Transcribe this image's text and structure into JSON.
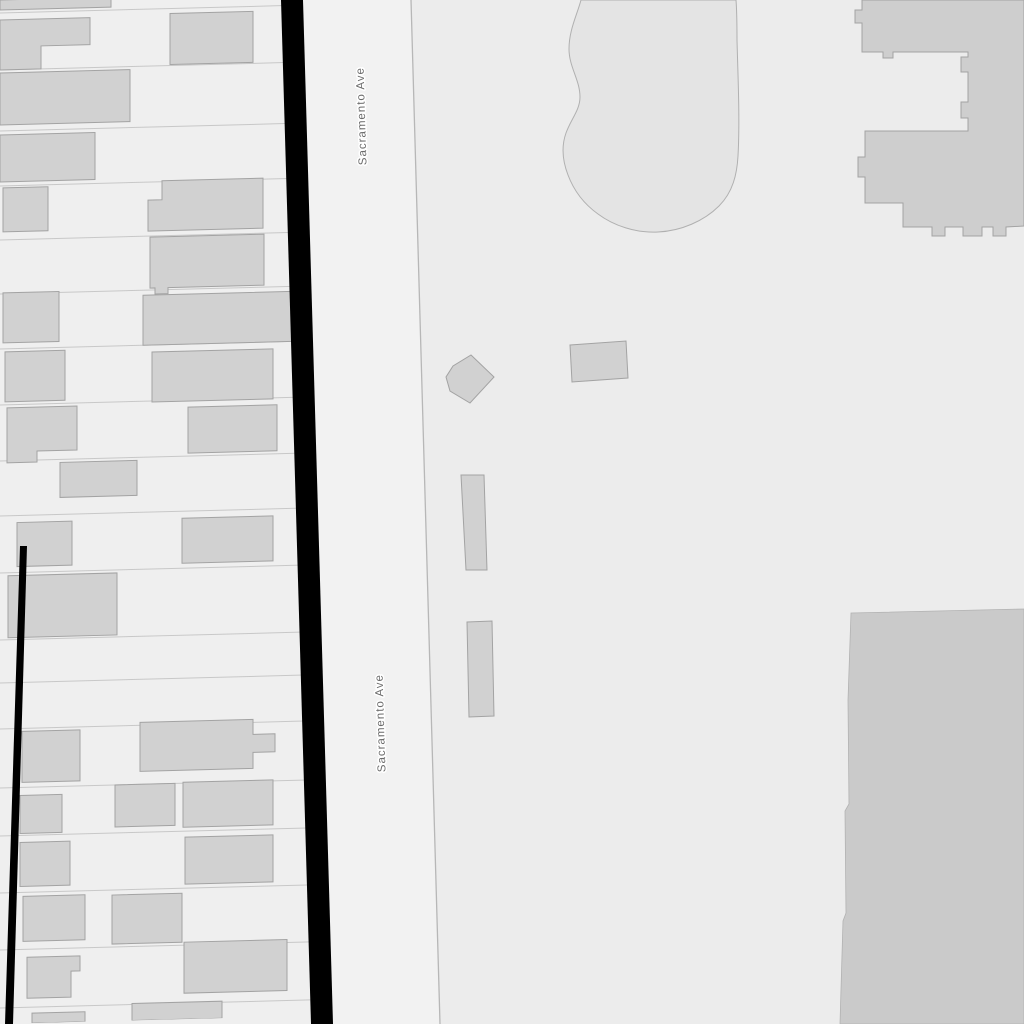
{
  "map": {
    "street": {
      "name": "Sacramento Ave"
    },
    "labels": [
      {
        "text": "Sacramento Ave"
      },
      {
        "text": "Sacramento Ave"
      }
    ],
    "colors": {
      "parcel_background": "#efefef",
      "parcel_line": "#c8c8c8",
      "building_fill": "#d1d1d1",
      "building_stroke": "#a3a3a3",
      "road_fill": "#f2f2f2",
      "road_casing": "#000000",
      "right_block_background": "#ececec",
      "boundary_line": "#b7b7b7",
      "pond_fill": "#e4e4e4",
      "pond_stroke": "#b0b0b0",
      "large_building_fill": "#cecece",
      "dark_block_fill": "#cacaca",
      "dark_block_stroke": "#b2b2b2",
      "label_color": "#6b6b6b",
      "label_halo": "#ffffff"
    }
  }
}
